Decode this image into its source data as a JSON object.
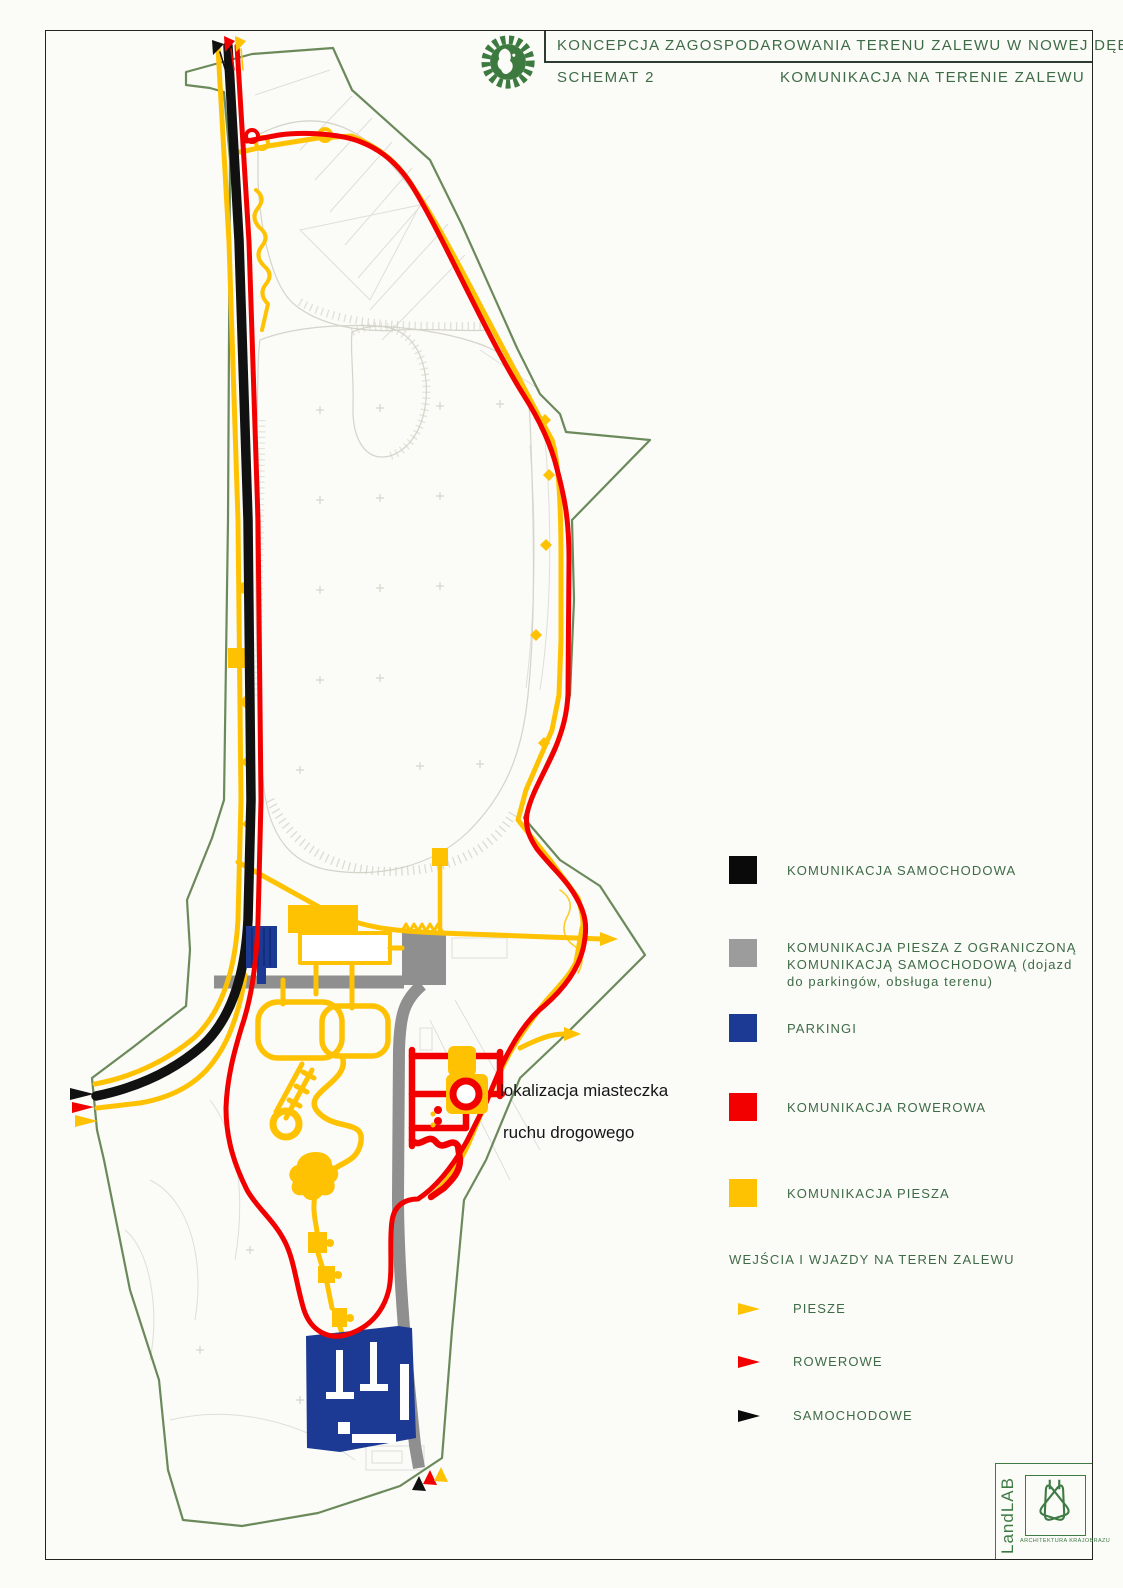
{
  "header": {
    "title": "KONCEPCJA ZAGOSPODAROWANIA TERENU ZALEWU W NOWEJ DĘBIE",
    "schema": "SCHEMAT 2",
    "subtitle": "KOMUNIKACJA NA TERENIE ZALEWU"
  },
  "map_labels": {
    "annotation_line1": "lokalizacja miasteczka",
    "annotation_line2": "ruchu drogowego"
  },
  "legend": {
    "items": [
      {
        "key": "car",
        "label": "KOMUNIKACJA SAMOCHODOWA",
        "color": "#0a0a0a",
        "swatch_style": "background:#0a0a0a"
      },
      {
        "key": "pedestrian-limited",
        "label": "KOMUNIKACJA PIESZA Z OGRANICZONĄ\nKOMUNIKACJĄ SAMOCHODOWĄ (dojazd\ndo parkingów, obsługa terenu)",
        "color": "#9c9c9c",
        "swatch_style": "background:#9c9c9c"
      },
      {
        "key": "parking",
        "label": "PARKINGI",
        "color": "#1c3a94",
        "swatch_style": "background:#1c3a94"
      },
      {
        "key": "bike",
        "label": "KOMUNIKACJA ROWEROWA",
        "color": "#f20000",
        "swatch_style": "background:#f20000"
      },
      {
        "key": "pedestrian",
        "label": "KOMUNIKACJA PIESZA",
        "color": "#ffc203",
        "swatch_style": "background:#ffc203"
      }
    ],
    "entries_header": "WEJŚCIA I WJAZDY NA TEREN ZALEWU",
    "entries": [
      {
        "key": "pedestrian",
        "label": "PIESZE",
        "color": "#ffc203"
      },
      {
        "key": "bike",
        "label": "ROWEROWE",
        "color": "#f20000"
      },
      {
        "key": "car",
        "label": "SAMOCHODOWE",
        "color": "#0a0a0a"
      }
    ]
  },
  "footer_logo": {
    "name": "LandLAB",
    "caption": "ARCHITEKTURA KRAJOBRAZU"
  },
  "colors": {
    "car_road": "#111111",
    "shared_road": "#8f8f8f",
    "parking": "#1c3a94",
    "bike_path": "#f20000",
    "pedestrian_path": "#ffc203",
    "site_boundary": "#6b8a5b",
    "heading_text": "#3e6b47",
    "page_background": "#fbfbf7"
  }
}
